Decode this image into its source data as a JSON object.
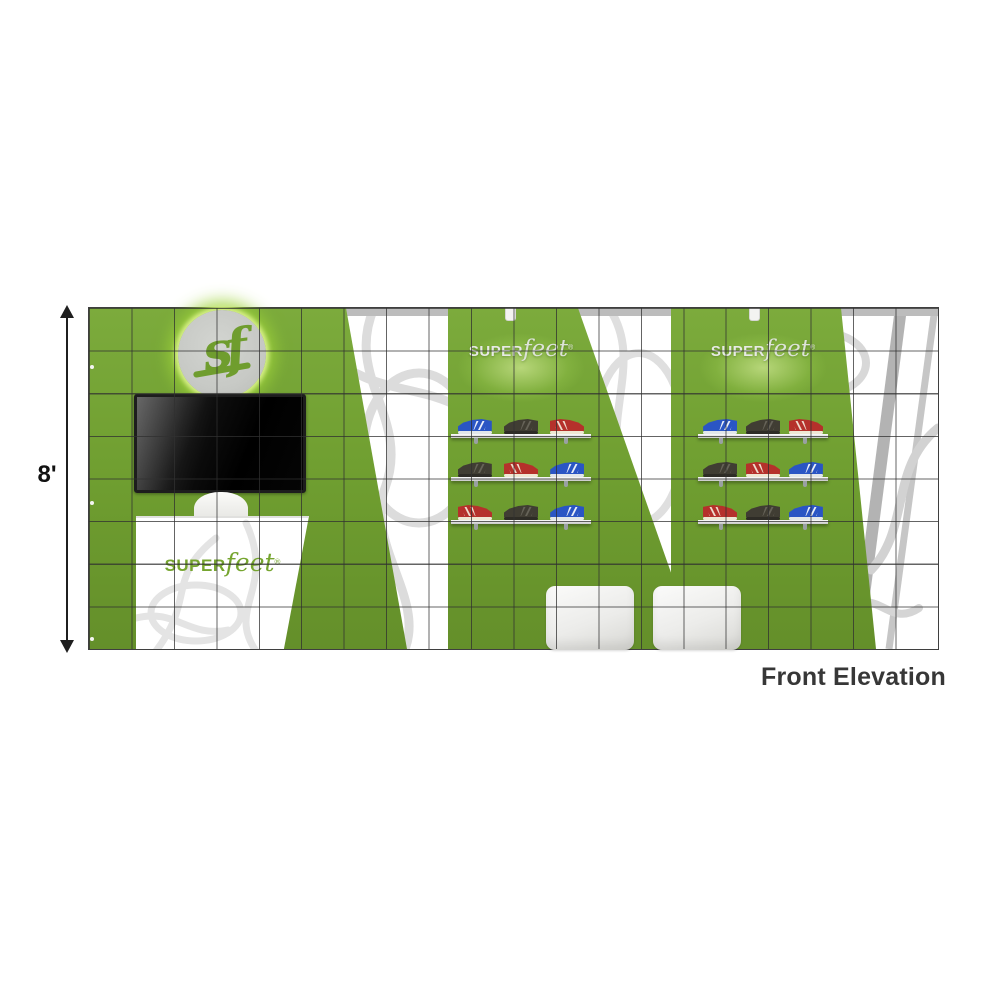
{
  "caption": "Front Elevation",
  "dimension_label": "8'",
  "brand": {
    "monogram": "sf",
    "wordmark_caps": "SUPER",
    "wordmark_script": "feet",
    "registered_mark": "®"
  },
  "grid": {
    "columns": 20,
    "rows": 8
  },
  "shelf_displays": [
    {
      "name": "center display",
      "wordmark": "SUPERfeet",
      "shelves": [
        [
          "blue",
          "black",
          "red"
        ],
        [
          "black",
          "red",
          "blue"
        ],
        [
          "red",
          "black",
          "blue"
        ]
      ]
    },
    {
      "name": "right display",
      "wordmark": "SUPERfeet",
      "shelves": [
        [
          "blue",
          "black",
          "red"
        ],
        [
          "black",
          "red",
          "blue"
        ],
        [
          "red",
          "black",
          "blue"
        ]
      ]
    }
  ],
  "shoe_styles": {
    "blue": {
      "upper": "#2a55c4",
      "sole": "#e3e7ea",
      "accent": "#ffffff",
      "toe": "left"
    },
    "black": {
      "upper": "#403d33",
      "sole": "#2e2c26",
      "accent": "#6a675c",
      "toe": "left"
    },
    "red": {
      "upper": "#b5312b",
      "sole": "#efe8d4",
      "accent": "#f4efdf",
      "toe": "right"
    }
  },
  "furniture": {
    "ottomans": 2,
    "monitor": 1,
    "counter": 1,
    "chair": 1
  },
  "colors": {
    "panel_green": "#6f9e30",
    "glow_green": "#b9e354",
    "logo_disc_gray": "#c9cbc7",
    "grid_line": "#3f3f3f",
    "pattern_gray": "#dcdcdc",
    "truss_gray": "#b3b3b3",
    "caption_text": "#373737"
  }
}
